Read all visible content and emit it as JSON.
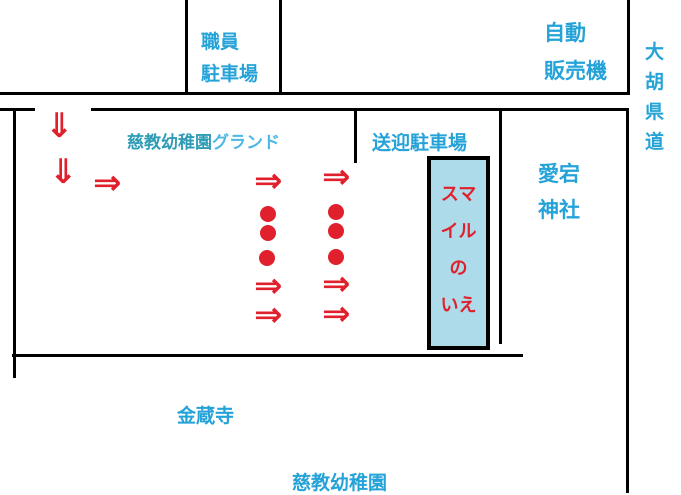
{
  "colors": {
    "red": "#e0202c",
    "blue": "#25a3d8",
    "teal": "#2e9cb5",
    "lightblue": "#4cb8e6",
    "fill": "#aedbe9",
    "line": "#000000",
    "bg": "#ffffff"
  },
  "map": {
    "staff_parking": {
      "line1": "職員",
      "line2": "駐車場"
    },
    "vending_machine": {
      "line1": "自動",
      "line2": "販売機"
    },
    "prefectural_road": {
      "c1": "大",
      "c2": "胡",
      "c3": "県",
      "c4": "道"
    },
    "ground": {
      "part1": "慈教幼稚園",
      "part2": "グランド"
    },
    "pickup_parking": {
      "text": "送迎駐車場"
    },
    "atago_shrine": {
      "line1": "愛宕",
      "line2": "神社"
    },
    "smile_house": {
      "l1": "スマ",
      "l2": "イル",
      "l3": "の",
      "l4": "いえ"
    },
    "kinzoji": {
      "text": "金蔵寺"
    },
    "kindergarten": {
      "text": "慈教幼稚園"
    }
  },
  "route": {
    "down_arrow": "⇓",
    "right_arrow": "⇒"
  }
}
